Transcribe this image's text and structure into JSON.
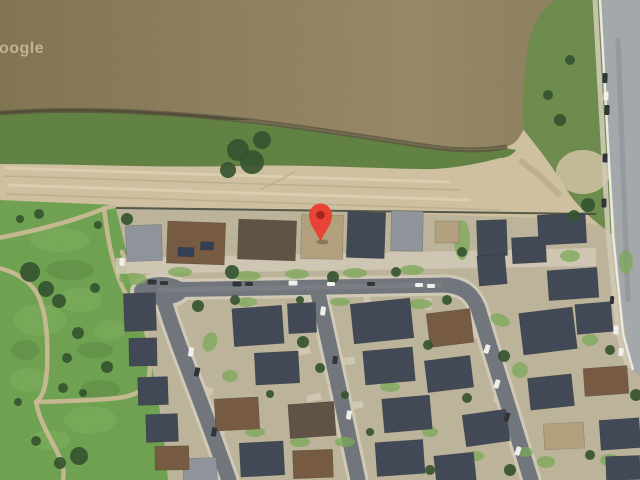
{
  "map": {
    "view_type": "satellite-imagery",
    "watermark": "Google",
    "marker": {
      "name": "location-pin",
      "x": 320.5,
      "y": 241,
      "color": "#E94335",
      "inner_color": "#7E180F"
    },
    "colors": {
      "water": "#8C7E5D",
      "water_hi": "#968765",
      "water_lo": "#80734F",
      "water_edge": "#59533C",
      "shore_green": "#5F8040",
      "scrub": "#6B8A4A",
      "sand": "#CFC1A1",
      "sand_track": "#B6A888",
      "sand_light": "#DFD5B6",
      "park": "#6DA14F",
      "park_path": "#C9BA93",
      "grass_lite": "#7EB25C",
      "grass_dark": "#55823C",
      "resid": "#BDB49A",
      "asphalt": "#6F747B",
      "concrete": "#D2CAB7",
      "wear": "#82878F",
      "road": "#A3A8AC",
      "curb": "#EDEBE4",
      "fence": "#3F4436",
      "tree": "#31502A",
      "lawn": "#7AA855",
      "roof_navy": "#3E4553",
      "roof_gray": "#8E939B",
      "roof_brown": "#74583F",
      "roof_darkbrown": "#5D4F41",
      "roof_tan": "#B2A07C",
      "roof_solar": "#2E3B52",
      "car_white": "#F2F1EC",
      "car_dark": "#2C3034",
      "marker": "#E94335",
      "marker_inner": "#7E180F",
      "watermark": "#EDE6CB"
    },
    "scene": {
      "houses": [
        [
          144,
          243,
          36,
          36,
          "gray",
          -2
        ],
        [
          196,
          243,
          58,
          42,
          "brown",
          2
        ],
        [
          186,
          252,
          16,
          9,
          "solar",
          2
        ],
        [
          207,
          246,
          13,
          8,
          "solar",
          2
        ],
        [
          267,
          240,
          58,
          40,
          "darkbrown",
          2
        ],
        [
          322,
          237,
          42,
          44,
          "tan",
          1
        ],
        [
          366,
          235,
          38,
          46,
          "navy",
          2
        ],
        [
          407,
          231,
          32,
          40,
          "gray",
          1
        ],
        [
          447,
          232,
          24,
          22,
          "tan",
          0
        ],
        [
          492,
          238,
          30,
          36,
          "navy",
          -2
        ],
        [
          529,
          250,
          34,
          26,
          "navy",
          -3
        ],
        [
          562,
          229,
          48,
          30,
          "navy",
          -3
        ],
        [
          573,
          284,
          50,
          30,
          "navy",
          -4
        ],
        [
          492,
          270,
          28,
          30,
          "navy",
          -5
        ],
        [
          258,
          326,
          50,
          38,
          "navy",
          -4
        ],
        [
          302,
          318,
          28,
          30,
          "navy",
          -3
        ],
        [
          382,
          321,
          60,
          40,
          "navy",
          -6
        ],
        [
          450,
          328,
          44,
          34,
          "brown",
          -7
        ],
        [
          548,
          331,
          54,
          42,
          "navy",
          -7
        ],
        [
          594,
          318,
          36,
          30,
          "navy",
          -5
        ],
        [
          277,
          368,
          44,
          32,
          "navy",
          -3
        ],
        [
          389,
          366,
          50,
          34,
          "navy",
          -5
        ],
        [
          449,
          374,
          46,
          32,
          "navy",
          -7
        ],
        [
          551,
          392,
          44,
          32,
          "navy",
          -6
        ],
        [
          606,
          381,
          44,
          28,
          "brown",
          -4
        ],
        [
          237,
          414,
          44,
          32,
          "brown",
          -3
        ],
        [
          312,
          420,
          46,
          34,
          "darkbrown",
          -4
        ],
        [
          407,
          414,
          48,
          34,
          "navy",
          -5
        ],
        [
          486,
          428,
          44,
          32,
          "navy",
          -8
        ],
        [
          564,
          436,
          40,
          26,
          "tan",
          -3
        ],
        [
          620,
          434,
          40,
          30,
          "navy",
          -4
        ],
        [
          262,
          459,
          44,
          34,
          "navy",
          -3
        ],
        [
          313,
          464,
          40,
          28,
          "brown",
          -2
        ],
        [
          400,
          458,
          48,
          34,
          "navy",
          -4
        ],
        [
          455,
          468,
          40,
          28,
          "navy",
          -6
        ],
        [
          623,
          468,
          34,
          24,
          "navy",
          -2
        ],
        [
          200,
          470,
          34,
          24,
          "gray",
          -2
        ],
        [
          140,
          312,
          32,
          38,
          "navy",
          -2
        ],
        [
          143,
          352,
          28,
          28,
          "navy",
          -1
        ],
        [
          153,
          391,
          30,
          28,
          "navy",
          -2
        ],
        [
          162,
          428,
          32,
          28,
          "navy",
          -2
        ],
        [
          172,
          458,
          34,
          24,
          "brown",
          -1
        ]
      ],
      "trees": [
        [
          238,
          150,
          11
        ],
        [
          252,
          162,
          12
        ],
        [
          262,
          140,
          9
        ],
        [
          228,
          170,
          8
        ],
        [
          560,
          120,
          6
        ],
        [
          548,
          95,
          5
        ],
        [
          570,
          60,
          5
        ],
        [
          588,
          205,
          7
        ],
        [
          574,
          216,
          6
        ],
        [
          30,
          272,
          10
        ],
        [
          46,
          289,
          8
        ],
        [
          59,
          301,
          7
        ],
        [
          95,
          288,
          5
        ],
        [
          78,
          333,
          6
        ],
        [
          67,
          358,
          5
        ],
        [
          107,
          367,
          6
        ],
        [
          63,
          388,
          5
        ],
        [
          83,
          393,
          4
        ],
        [
          36,
          441,
          5
        ],
        [
          79,
          456,
          9
        ],
        [
          60,
          463,
          6
        ],
        [
          20,
          219,
          4
        ],
        [
          39,
          214,
          5
        ],
        [
          98,
          225,
          4
        ],
        [
          18,
          402,
          4
        ],
        [
          127,
          219,
          6
        ],
        [
          232,
          272,
          7
        ],
        [
          333,
          277,
          6
        ],
        [
          396,
          272,
          5
        ],
        [
          303,
          342,
          6
        ],
        [
          320,
          368,
          5
        ],
        [
          428,
          345,
          5
        ],
        [
          447,
          300,
          5
        ],
        [
          504,
          356,
          6
        ],
        [
          467,
          398,
          5
        ],
        [
          235,
          300,
          5
        ],
        [
          198,
          306,
          6
        ],
        [
          610,
          350,
          5
        ],
        [
          636,
          395,
          6
        ],
        [
          590,
          455,
          5
        ],
        [
          510,
          470,
          6
        ],
        [
          430,
          470,
          5
        ],
        [
          345,
          395,
          4
        ],
        [
          370,
          432,
          4
        ],
        [
          270,
          394,
          4
        ],
        [
          300,
          300,
          4
        ],
        [
          462,
          252,
          5
        ]
      ],
      "lawns": [
        [
          133,
          279,
          14,
          6,
          0
        ],
        [
          180,
          272,
          12,
          5,
          0
        ],
        [
          247,
          276,
          14,
          5,
          0
        ],
        [
          297,
          274,
          12,
          5,
          0
        ],
        [
          355,
          273,
          12,
          5,
          0
        ],
        [
          412,
          270,
          12,
          5,
          0
        ],
        [
          247,
          302,
          10,
          5,
          0
        ],
        [
          340,
          302,
          10,
          4,
          0
        ],
        [
          420,
          304,
          12,
          5,
          0
        ],
        [
          500,
          320,
          10,
          6,
          20
        ],
        [
          590,
          340,
          8,
          6,
          0
        ],
        [
          210,
          342,
          7,
          10,
          20
        ],
        [
          230,
          376,
          8,
          6,
          0
        ],
        [
          255,
          432,
          10,
          5,
          0
        ],
        [
          300,
          442,
          10,
          5,
          0
        ],
        [
          345,
          442,
          10,
          5,
          0
        ],
        [
          390,
          387,
          10,
          5,
          0
        ],
        [
          430,
          432,
          8,
          5,
          0
        ],
        [
          520,
          370,
          8,
          8,
          0
        ],
        [
          610,
          460,
          10,
          6,
          0
        ],
        [
          525,
          452,
          8,
          5,
          0
        ],
        [
          462,
          240,
          8,
          20,
          0
        ],
        [
          570,
          256,
          10,
          6,
          0
        ],
        [
          626,
          262,
          7,
          12,
          0
        ],
        [
          546,
          462,
          9,
          6,
          0
        ],
        [
          476,
          456,
          8,
          5,
          0
        ]
      ],
      "cars": [
        [
          605,
          78,
          5,
          10,
          "d",
          2
        ],
        [
          607,
          110,
          5,
          10,
          "d",
          2
        ],
        [
          606,
          96,
          5,
          9,
          "w",
          2
        ],
        [
          605,
          158,
          5,
          9,
          "d",
          1
        ],
        [
          604,
          203,
          5,
          9,
          "d",
          1
        ],
        [
          612,
          300,
          4,
          8,
          "d",
          3
        ],
        [
          616,
          330,
          5,
          9,
          "w",
          4
        ],
        [
          621,
          352,
          5,
          8,
          "w",
          5
        ],
        [
          152,
          282,
          9,
          5,
          "d",
          0
        ],
        [
          164,
          283,
          8,
          4,
          "d",
          0
        ],
        [
          237,
          284,
          9,
          5,
          "d",
          0
        ],
        [
          249,
          284,
          8,
          4,
          "d",
          0
        ],
        [
          293,
          283,
          9,
          5,
          "w",
          0
        ],
        [
          331,
          284,
          8,
          4,
          "w",
          0
        ],
        [
          371,
          284,
          8,
          4,
          "d",
          0
        ],
        [
          419,
          285,
          8,
          4,
          "w",
          0
        ],
        [
          431,
          286,
          8,
          4,
          "w",
          0
        ],
        [
          191,
          352,
          5,
          9,
          "w",
          10
        ],
        [
          197,
          372,
          5,
          9,
          "d",
          12
        ],
        [
          214,
          432,
          5,
          9,
          "d",
          10
        ],
        [
          323,
          311,
          5,
          9,
          "w",
          8
        ],
        [
          335,
          360,
          5,
          8,
          "d",
          8
        ],
        [
          349,
          415,
          5,
          9,
          "w",
          8
        ],
        [
          487,
          349,
          5,
          9,
          "w",
          18
        ],
        [
          497,
          384,
          5,
          9,
          "w",
          18
        ],
        [
          507,
          417,
          5,
          9,
          "d",
          18
        ],
        [
          518,
          451,
          5,
          9,
          "w",
          18
        ],
        [
          122,
          262,
          5,
          8,
          "w",
          0
        ]
      ]
    }
  }
}
